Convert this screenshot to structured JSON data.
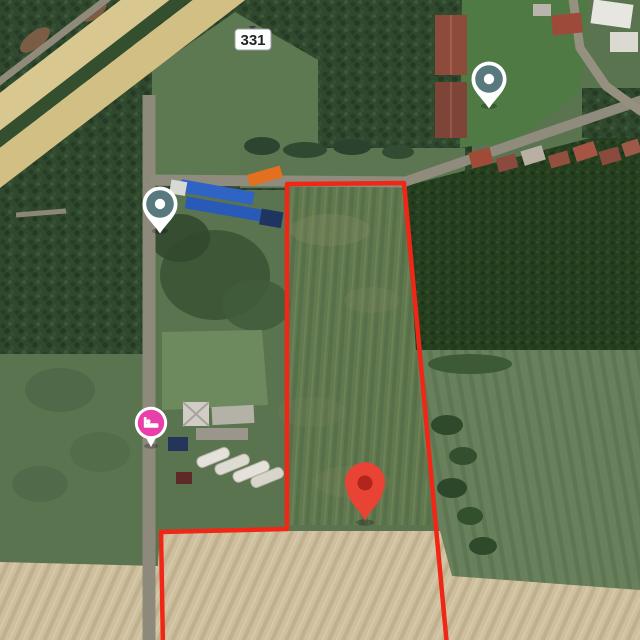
{
  "map": {
    "view_type": "satellite",
    "road_shield": {
      "label": "331"
    },
    "parcel": {
      "boundary_color": "#f12616",
      "path": "M163,646 L161,532 L287,529 L287,184 L404,183 L447,646"
    },
    "markers": [
      {
        "name": "destination-pin",
        "color": "#e84335",
        "inner_color": "#b1251c",
        "x": 365,
        "y": 521,
        "transform": "translate(365,521)"
      },
      {
        "name": "poi-pin-top-right",
        "color": "#587a7e",
        "x": 489,
        "y": 79,
        "transform": "translate(489,79)"
      },
      {
        "name": "poi-pin-left",
        "color": "#587a7e",
        "x": 160,
        "y": 204,
        "transform": "translate(160,204)"
      },
      {
        "name": "lodging-pin",
        "color": "#e83fa8",
        "icon": "bed-icon",
        "x": 151,
        "y": 423,
        "transform": "translate(151,423)"
      }
    ],
    "palette": {
      "vegetation_dark": "#30492e",
      "vegetation_scrub": "#5a7450",
      "parcel_field_green": "#62794f",
      "plowed_field_tan": "#cec09f",
      "highway_tan": "#d8c78f",
      "road_gray": "#8f8b7d",
      "boundary_red": "#f12616"
    }
  }
}
